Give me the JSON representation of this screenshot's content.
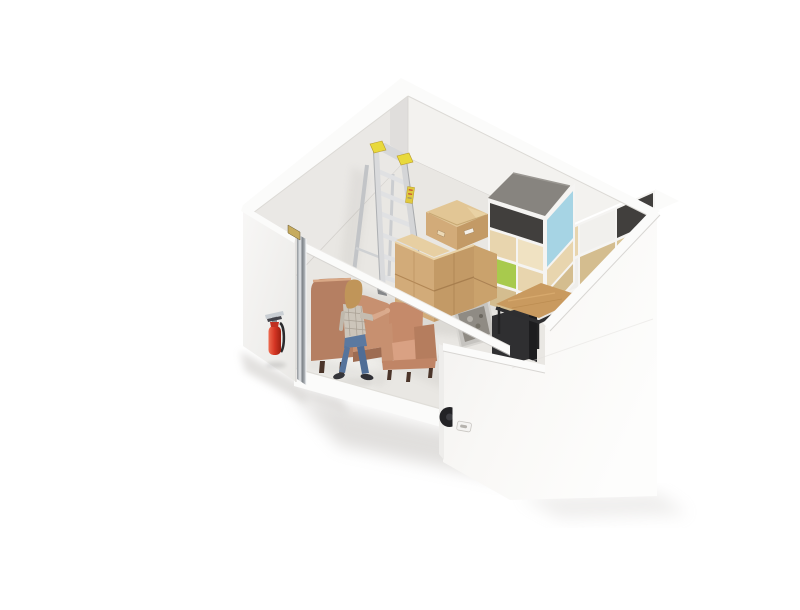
{
  "meta": {
    "description": "3D cutaway rendering of a small self-storage unit containing a stepladder, stacked cardboard boxes, a cube shelving unit with colored panels, a wooden side table with a dark bin and a gray tote, two terracotta armchairs, a white pot, an open chrome-edged door with a fire extinguisher mounted outside, and a person in a plaid shirt and jeans standing inside"
  },
  "scene": {
    "objects": [
      "room-walls",
      "floor",
      "door-open",
      "fire-extinguisher",
      "stepladder",
      "cardboard-boxes",
      "cube-shelving-unit",
      "side-table",
      "dark-bin",
      "gray-tote",
      "white-pot",
      "wingback-armchair",
      "small-armchair",
      "person-standing",
      "front-right-wall",
      "wall-latch",
      "black-wheel"
    ]
  },
  "colors": {
    "background": "#ffffff",
    "wall_cap": "#fbfbfa",
    "wall_interior_left": "#eae8e5",
    "wall_interior_right": "#f3f2ef",
    "wall_exterior_left": "#f5f4f2",
    "pillar_face": "#f8f7f5",
    "pillar_end": "#eeedeb",
    "floor": "#e9e7e3",
    "slab_edge": "#fbfbfa",
    "beam": "#fbfbfa",
    "door_chrome": "#a9aeb3",
    "hinge_brass": "#c6ab5e",
    "ladder_metal": "#d9dadc",
    "ladder_metal_dark": "#c2c4c7",
    "ladder_rung": "#e0e1e3",
    "ladder_yellow": "#e8d93c",
    "cardboard_top": "#e2c695",
    "cardboard_light": "#d2ab79",
    "cardboard_dark": "#c39a66",
    "cardboard_side": "#caa26c",
    "shelf_top_gray": "#87847f",
    "shelf_blue": "#a6d4e4",
    "shelf_green": "#a8ca4d",
    "shelf_wood": "#e8d5ae",
    "shelf_wood_light": "#f0e2c2",
    "shelf_wood_dark": "#d4bd8f",
    "shelf_dark": "#413f3d",
    "shelf_white": "#f5f4f2",
    "table_wood": "#c99a5f",
    "bin_dark": "#2f2f31",
    "bin_top": "#5c5c60",
    "tote_gray": "#c6c4c0",
    "tote_junk": "#8f8b84",
    "pot_white": "#fcfcfb",
    "chair_main": "#b57f62",
    "chair_light": "#c79070",
    "chair_arm_dark": "#b57d5e",
    "chair_cushion": "#d9a183",
    "chair_leg": "#4b352a",
    "extinguisher_red": "#d43523",
    "skin": "#d9a98c",
    "hair": "#c09559",
    "shirt": "#ccc5ba",
    "jeans": "#5b79a0",
    "jeans_dark": "#4f6d96",
    "shoe": "#35353a",
    "wheel_black": "#232326",
    "latch_plate": "#f4f3f1"
  }
}
